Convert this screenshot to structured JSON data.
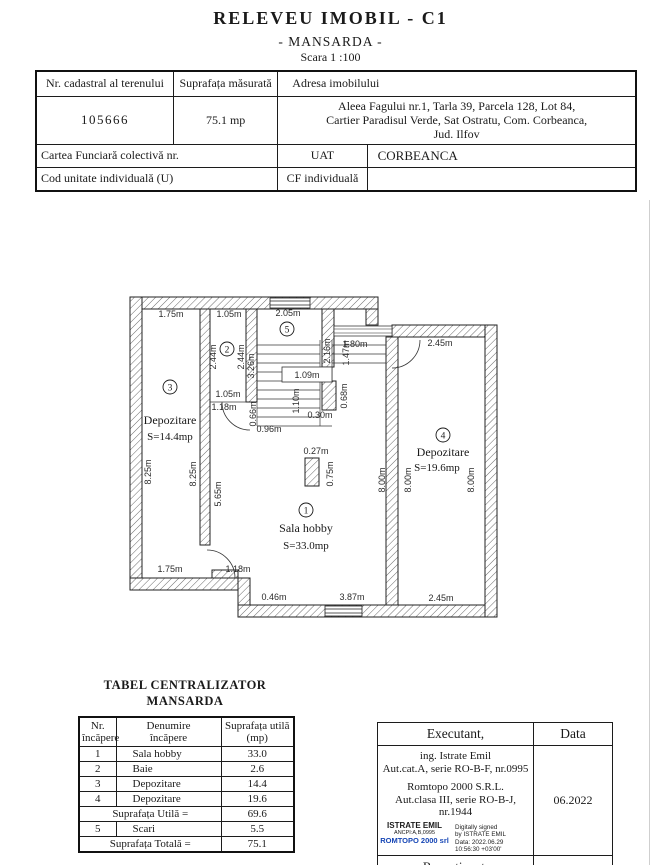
{
  "title": {
    "main": "RELEVEU  IMOBIL - C1",
    "sub": "- MANSARDA -",
    "scale": "Scara 1 :100"
  },
  "header_table": {
    "col1_label": "Nr. cadastral al terenului",
    "col2_label": "Suprafața măsurată",
    "col3_label": "Adresa  imobilului",
    "cadastral_number": "105666",
    "measured_area": "75.1 mp",
    "address_line1": "Aleea Fagului nr.1, Tarla 39, Parcela 128, Lot 84,",
    "address_line2": "Cartier Paradisul Verde, Sat Ostratu, Com. Corbeanca,",
    "address_line3": "Jud. Ilfov",
    "row3_label": "Cartea Funciară colectivă nr.",
    "uat_label": "UAT",
    "uat_value": "CORBEANCA",
    "row4_label": "Cod unitate individuală (U)",
    "cf_label": "CF individuală"
  },
  "floor_plan": {
    "rooms": {
      "hobby": {
        "num": "1",
        "name": "Sala hobby",
        "area": "S=33.0mp"
      },
      "bath": {
        "num": "2"
      },
      "dep3": {
        "num": "3",
        "name": "Depozitare",
        "area": "S=14.4mp"
      },
      "dep4": {
        "num": "4",
        "name": "Depozitare",
        "area": "S=19.6mp"
      },
      "stairs": {
        "num": "5"
      }
    },
    "dims": {
      "top_left_width": "1.75m",
      "bath_width_top": "1.05m",
      "stair_width": "2.05m",
      "terrace_door": "1.80m",
      "dep4_width_top": "2.45m",
      "bath_height_left": "2.44m",
      "bath_height_right": "2.44m",
      "bath_width_bottom": "1.05m",
      "bath_door": "1.18m",
      "bath_jamb": "0.66m",
      "stair_flight_left": "3.26m",
      "stair_flight_right": "2.16m",
      "stair_mid": "1.09m",
      "stair_landing": "1.47m",
      "stair_lower_width": "1.10m",
      "stair_bottom": "0.96m",
      "post_width": "0.30m",
      "post_height": "0.68m",
      "dep3_height_outer": "8.25m",
      "dep3_height_inner": "8.25m",
      "hobby_height_left": "5.65m",
      "dep4_height_left1": "8.00m",
      "dep4_height_left2": "8.00m",
      "dep4_height_right": "8.00m",
      "chimney_width": "0.27m",
      "chimney_height": "0.75m",
      "bottom_left_width": "1.75m",
      "hobby_door": "1.18m",
      "bottom_step": "0.46m",
      "hobby_width_bottom": "3.87m",
      "dep4_width_bottom": "2.45m"
    }
  },
  "summary_table": {
    "title_line1": "TABEL CENTRALIZATOR",
    "title_line2": "MANSARDA",
    "col_nr_line1": "Nr.",
    "col_nr_line2": "încăpere",
    "col_den_line1": "Denumire",
    "col_den_line2": "încăpere",
    "col_sup_line1": "Suprafața utilă",
    "col_sup_line2": "(mp)",
    "rows": [
      [
        "1",
        "Sala hobby",
        "33.0"
      ],
      [
        "2",
        "Baie",
        "2.6"
      ],
      [
        "3",
        "Depozitare",
        "14.4"
      ],
      [
        "4",
        "Depozitare",
        "19.6"
      ]
    ],
    "util_label": "Suprafața Utilă  =",
    "util_value": "69.6",
    "stairs_row": [
      "5",
      "Scari",
      "5.5"
    ],
    "total_label": "Suprafața Totală =",
    "total_value": "75.1"
  },
  "executant_table": {
    "header_left": "Executant,",
    "header_right": "Data",
    "line1": "ing. Istrate Emil",
    "line2": "Aut.cat.A, serie RO-B-F, nr.0995",
    "line3": "Romtopo 2000 S.R.L.",
    "line4": "Aut.clasa III, serie RO-B-J, nr.1944",
    "stamp_name": "ISTRATE EMIL",
    "stamp_id": "ANCPI:A,B,0995",
    "stamp_company": "ROMTOPO 2000 srl",
    "stamp_company_color": "#1646b5",
    "sig_line1": "Digitally signed",
    "sig_line2": "by ISTRATE EMIL",
    "sig_line3": "Data: 2022.06.29",
    "sig_line4": "10:56:30 +03'00'",
    "date_value": "06.2022",
    "footer": "Recepționat,"
  }
}
